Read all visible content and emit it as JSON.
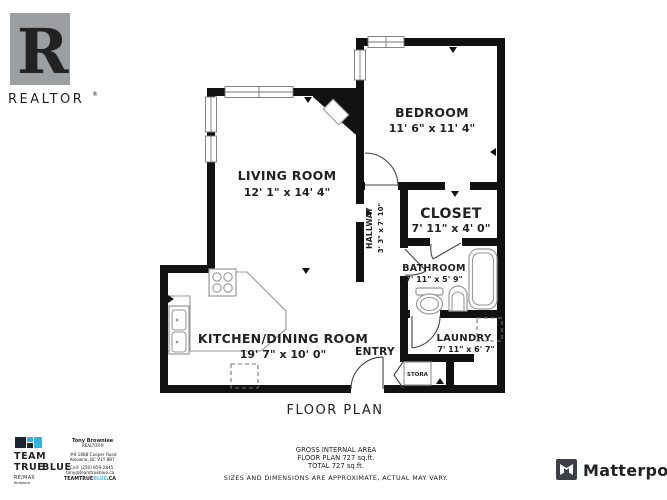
{
  "branding": {
    "realtor": {
      "label": "REALTOR",
      "reg": "®",
      "r_glyph": "R"
    },
    "matterport": {
      "label": "Matterport"
    },
    "team": {
      "team": "TEAM",
      "true": "TRUE",
      "blue": "BLUE",
      "remax": "RE/MAX",
      "remax_sub": "Kelowna",
      "agent_name": "Tony Brownlee",
      "agent_title": "REALTOR®",
      "agent_addr1": "#8-1888 Cooper Road",
      "agent_addr2": "Kelowna, BC V1Y 8B7",
      "agent_phone": "Cell: (250) 859-2845",
      "agent_email": "tony@teamtrueblue.ca",
      "agent_site1": "TEAMTRUE",
      "agent_site2": "BLUE",
      "agent_site3": ".CA"
    }
  },
  "plan": {
    "title": "FLOOR PLAN",
    "rooms": {
      "living": {
        "name": "LIVING ROOM",
        "dims": "12' 1\" x 14' 4\""
      },
      "bedroom": {
        "name": "BEDROOM",
        "dims": "11' 6\" x 11' 4\""
      },
      "closet": {
        "name": "CLOSET",
        "dims": "7' 11\" x 4' 0\""
      },
      "hallway": {
        "name": "HALLWAY",
        "dims": "3' 3\" x 7' 10\""
      },
      "bathroom": {
        "name": "BATHROOM",
        "dims": "7' 11\" x 5' 9\""
      },
      "kitchen": {
        "name": "KITCHEN/DINING ROOM",
        "dims": "19' 7\" x 10' 0\""
      },
      "entry": {
        "name": "ENTRY"
      },
      "laundry": {
        "name": "LAUNDRY",
        "dims": "7' 11\" x 6' 7\""
      },
      "storage": {
        "name": "STORA"
      }
    }
  },
  "footer": {
    "line1": "GROSS INTERNAL AREA",
    "line2": "FLOOR PLAN 727 sq.ft.",
    "line3": "TOTAL 727  sq.ft.",
    "disclaimer": "SIZES AND DIMENSIONS ARE APPROXIMATE, ACTUAL MAY VARY."
  },
  "colors": {
    "wall": "#111111",
    "fixture_gray": "#999999",
    "logo_gray": "#9b9b9b",
    "team_blue": "#5bc0e8",
    "matterport_dark": "#3b4046"
  }
}
